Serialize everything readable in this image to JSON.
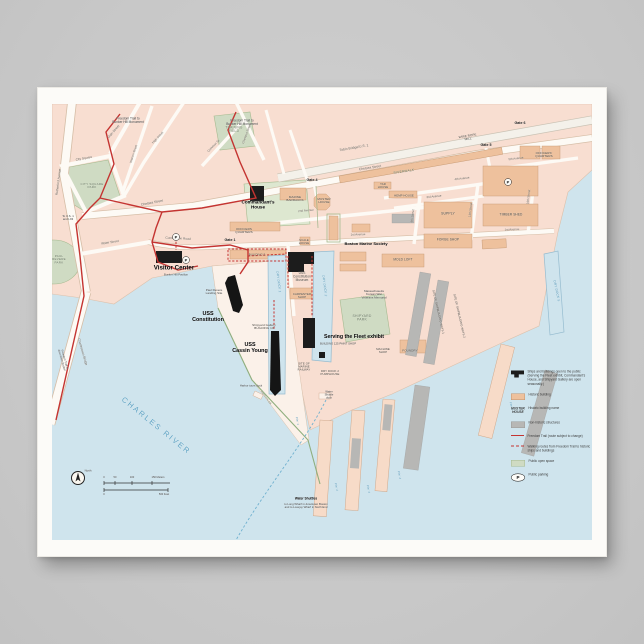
{
  "colors": {
    "page_background": "#c7c7c7",
    "poster_paper": "#fcfbf8",
    "water": "#cfe4ed",
    "land": "#f8ded1",
    "historic_building": "#eec19d",
    "nonhistoric_structure": "#b7b7b5",
    "open_space_green": "#cfdbc3",
    "freedom_trail_red": "#c43431",
    "open_public_black": "#1c1c1c",
    "water_label_blue": "#4e93b5",
    "river_label_blue": "#5aa0c2"
  },
  "map": {
    "labels": [
      {
        "t": "Freedom Trail to\nBunker Hill Monument",
        "x": 76,
        "y": 17,
        "f": 3.2,
        "c": "tiny"
      },
      {
        "t": "Freedom Trail to\nBunker Hill Monument",
        "x": 190,
        "y": 19,
        "f": 3.2,
        "c": "tiny"
      },
      {
        "t": "TRAINING\nFIELD",
        "x": 182,
        "y": 26,
        "f": 3.2,
        "c": "park"
      },
      {
        "t": "Gate 6",
        "x": 468,
        "y": 19,
        "f": 3.6,
        "c": "gate"
      },
      {
        "t": "Gate 5",
        "x": 434,
        "y": 41,
        "f": 3.6,
        "c": "gate"
      },
      {
        "t": "Gate 4",
        "x": 260,
        "y": 76,
        "f": 3.6,
        "c": "gate"
      },
      {
        "t": "Gate 1",
        "x": 178,
        "y": 136,
        "f": 3.6,
        "c": "gate"
      },
      {
        "t": "Tobin Bridge/U.S. 1",
        "x": 302,
        "y": 44,
        "f": 3.4,
        "c": "street",
        "r": -10
      },
      {
        "t": "Chelsea Street",
        "x": 100,
        "y": 99,
        "f": 3.4,
        "c": "street",
        "r": -11
      },
      {
        "t": "Chelsea Street",
        "x": 318,
        "y": 64,
        "f": 3.4,
        "c": "street",
        "r": -9
      },
      {
        "t": "RIVERWALK",
        "x": 352,
        "y": 68,
        "f": 3.2,
        "c": "park",
        "r": -9
      },
      {
        "t": "Main Street",
        "x": 62,
        "y": 28,
        "f": 3.2,
        "c": "street",
        "r": -49
      },
      {
        "t": "Warren Street",
        "x": 82,
        "y": 50,
        "f": 3,
        "c": "street",
        "r": -72
      },
      {
        "t": "High Street",
        "x": 106,
        "y": 34,
        "f": 3,
        "c": "street",
        "r": -47
      },
      {
        "t": "Common St.",
        "x": 162,
        "y": 42,
        "f": 3,
        "c": "street",
        "r": -46
      },
      {
        "t": "Chestnut Street",
        "x": 195,
        "y": 30,
        "f": 3,
        "c": "street",
        "r": -70
      },
      {
        "t": "City Square",
        "x": 32,
        "y": 55,
        "f": 3.2,
        "c": "street",
        "r": -10
      },
      {
        "t": "CITY SQUARE\nPARK",
        "x": 40,
        "y": 82,
        "f": 3,
        "c": "park"
      },
      {
        "t": "Rutherford Avenue",
        "x": 7,
        "y": 78,
        "f": 3.2,
        "c": "street",
        "r": -83
      },
      {
        "t": "To U.S. 1\nand I-93",
        "x": 16,
        "y": 114,
        "f": 2.8,
        "c": "tiny"
      },
      {
        "t": "Water Street",
        "x": 58,
        "y": 139,
        "f": 3.2,
        "c": "street",
        "r": -9
      },
      {
        "t": "Constitution Road",
        "x": 126,
        "y": 135,
        "f": 3.2,
        "c": "street",
        "r": 3
      },
      {
        "t": "PAUL\nREVERE\nPARK",
        "x": 7,
        "y": 156,
        "f": 3,
        "c": "park"
      },
      {
        "t": "Charlestown Bridge",
        "x": 30,
        "y": 248,
        "f": 3.2,
        "c": "street",
        "r": 74
      },
      {
        "t": "Freedom Trail to\ndowntown Boston",
        "x": 11,
        "y": 256,
        "f": 2.8,
        "c": "tiny",
        "r": 74
      },
      {
        "t": "Commandant's\nHouse",
        "x": 206,
        "y": 101,
        "f": 4.6,
        "c": "poi",
        "n": "commandants-house-label"
      },
      {
        "t": "MARINE\nBARRACKS",
        "x": 243,
        "y": 95,
        "f": 3,
        "c": "bldg"
      },
      {
        "t": "MUSTER\nHOUSE",
        "x": 272,
        "y": 97,
        "f": 3,
        "c": "bldg"
      },
      {
        "t": "2nd Avenue",
        "x": 254,
        "y": 107,
        "f": 3,
        "c": "street",
        "r": -5
      },
      {
        "t": "3rd Avenue",
        "x": 382,
        "y": 93,
        "f": 3,
        "c": "street",
        "r": -6
      },
      {
        "t": "4th Avenue",
        "x": 410,
        "y": 75,
        "f": 3,
        "c": "street",
        "r": -7
      },
      {
        "t": "5th Avenue",
        "x": 464,
        "y": 55,
        "f": 3,
        "c": "street",
        "r": -7
      },
      {
        "t": "9th Street",
        "x": 361,
        "y": 112,
        "f": 3,
        "c": "street",
        "r": -83
      },
      {
        "t": "13th Street",
        "x": 419,
        "y": 106,
        "f": 3,
        "c": "street",
        "r": -83
      },
      {
        "t": "16th Street",
        "x": 477,
        "y": 93,
        "f": 3,
        "c": "street",
        "r": -83
      },
      {
        "t": "OFFICERS'\nQUARTERS",
        "x": 492,
        "y": 51,
        "f": 3,
        "c": "bldg"
      },
      {
        "t": "WIRE ROPE\nMILL",
        "x": 416,
        "y": 34,
        "f": 3,
        "c": "bldg",
        "r": -9
      },
      {
        "t": "TAR\nHOUSE",
        "x": 331,
        "y": 82,
        "f": 2.8,
        "c": "bldg"
      },
      {
        "t": "HEMP HOUSE",
        "x": 352,
        "y": 92,
        "f": 2.8,
        "c": "bldg"
      },
      {
        "t": "SUPPLY",
        "x": 396,
        "y": 110,
        "f": 3.4,
        "c": "bldg"
      },
      {
        "t": "FORGE SHOP",
        "x": 396,
        "y": 136,
        "f": 3.2,
        "c": "bldg"
      },
      {
        "t": "TIMBER SHED",
        "x": 459,
        "y": 111,
        "f": 3.2,
        "c": "bldg"
      },
      {
        "t": "MOLD LOFT",
        "x": 351,
        "y": 156,
        "f": 3.2,
        "c": "bldg"
      },
      {
        "t": "OFFICERS\nQUARTERS",
        "x": 192,
        "y": 127,
        "f": 3,
        "c": "bldg"
      },
      {
        "t": "BUILDING 5",
        "x": 205,
        "y": 151,
        "f": 2.8,
        "c": "bldg"
      },
      {
        "t": "SCALE\nHOUSE",
        "x": 252,
        "y": 138,
        "f": 2.8,
        "c": "bldg"
      },
      {
        "t": "Boston Marine Society",
        "x": 314,
        "y": 140,
        "f": 4,
        "c": "poi",
        "n": "boston-marine-society-label"
      },
      {
        "t": "1st Avenue",
        "x": 306,
        "y": 131,
        "f": 3,
        "c": "street",
        "r": -2
      },
      {
        "t": "1st Avenue",
        "x": 460,
        "y": 126,
        "f": 3,
        "c": "street",
        "r": -3
      },
      {
        "t": "Visitor Center",
        "x": 122,
        "y": 164,
        "f": 6.2,
        "c": "poi",
        "n": "visitor-center-label"
      },
      {
        "t": "Bunker Hill Pavilion",
        "x": 124,
        "y": 171,
        "f": 2.8,
        "c": "tiny"
      },
      {
        "t": "USS\nConstitution\nMuseum",
        "x": 250,
        "y": 173,
        "f": 3.2,
        "c": "bldg"
      },
      {
        "t": "Paul Revere\nLanding Site",
        "x": 162,
        "y": 188,
        "f": 3,
        "c": "tiny"
      },
      {
        "t": "USS\nConstitution",
        "x": 156,
        "y": 213,
        "f": 5.4,
        "c": "poi",
        "n": "uss-constitution-label"
      },
      {
        "t": "DRY DOCK 1",
        "x": 226,
        "y": 178,
        "f": 3.2,
        "c": "water",
        "r": 83
      },
      {
        "t": "DRY DOCK 2",
        "x": 272,
        "y": 182,
        "f": 3.2,
        "c": "water",
        "r": 83
      },
      {
        "t": "CARPENTER\nSHOP",
        "x": 250,
        "y": 192,
        "f": 2.8,
        "c": "bldg"
      },
      {
        "t": "Shipyard Gallery\nBUILDING 10",
        "x": 212,
        "y": 223,
        "f": 3,
        "c": "bldg"
      },
      {
        "t": "USS\nCassin Young",
        "x": 198,
        "y": 244,
        "f": 5.4,
        "c": "poi",
        "n": "uss-cassin-young-label"
      },
      {
        "t": "Serving the Fleet exhibit",
        "x": 302,
        "y": 233,
        "f": 5.2,
        "c": "poi",
        "n": "serving-the-fleet-label"
      },
      {
        "t": "BUILDING 125 PAINT SHOP",
        "x": 286,
        "y": 240,
        "f": 2.8,
        "c": "tiny"
      },
      {
        "t": "Massachusetts\nKorean War\nVeterans Memorial",
        "x": 322,
        "y": 191,
        "f": 3,
        "c": "tiny"
      },
      {
        "t": "SHIPYARD\nPARK",
        "x": 310,
        "y": 214,
        "f": 3.4,
        "c": "park"
      },
      {
        "t": "MACHINE\nSHOP",
        "x": 331,
        "y": 247,
        "f": 2.8,
        "c": "bldg"
      },
      {
        "t": "FOUNDRY",
        "x": 358,
        "y": 247,
        "f": 3,
        "c": "bldg"
      },
      {
        "t": "SITE OF\nMARINE\nRAILWAY",
        "x": 252,
        "y": 263,
        "f": 2.8,
        "c": "bldg"
      },
      {
        "t": "DRY DOCK 2\nPUMPHOUSE",
        "x": 278,
        "y": 269,
        "f": 2.8,
        "c": "bldg"
      },
      {
        "t": "Water\nShuttle\ndock",
        "x": 277,
        "y": 291,
        "f": 2.8,
        "c": "tiny"
      },
      {
        "t": "Harbor tours dock",
        "x": 199,
        "y": 282,
        "f": 2.8,
        "c": "tiny"
      },
      {
        "t": "SITE OF SHIPBUILDING WAYS 1",
        "x": 386,
        "y": 208,
        "f": 2.8,
        "c": "bldg",
        "r": 77
      },
      {
        "t": "SITE OF SHIPBUILDING WAYS 2",
        "x": 407,
        "y": 212,
        "f": 2.8,
        "c": "bldg",
        "r": 77
      },
      {
        "t": "DRY DOCK 5",
        "x": 504,
        "y": 187,
        "f": 3.2,
        "c": "water",
        "r": 78
      },
      {
        "t": "Pier 1",
        "x": 245,
        "y": 317,
        "f": 2.8,
        "c": "water",
        "r": 80
      },
      {
        "t": "Pier 2",
        "x": 284,
        "y": 383,
        "f": 2.8,
        "c": "water",
        "r": 80
      },
      {
        "t": "Pier 3",
        "x": 316,
        "y": 385,
        "f": 2.8,
        "c": "water",
        "r": 80
      },
      {
        "t": "Pier 4",
        "x": 347,
        "y": 371,
        "f": 2.8,
        "c": "water",
        "r": 80
      },
      {
        "t": "Pier 6",
        "x": 459,
        "y": 302,
        "f": 2.8,
        "c": "water",
        "r": 76
      },
      {
        "t": "Harborwalk",
        "x": 214,
        "y": 294,
        "f": 2.8,
        "c": "park",
        "r": 54
      },
      {
        "t": "CHARLES RIVER",
        "x": 104,
        "y": 322,
        "f": 7.5,
        "c": "river",
        "r": 39,
        "n": "charles-river-label"
      },
      {
        "t": "North",
        "x": 36,
        "y": 367,
        "f": 2.8,
        "c": "tiny"
      },
      {
        "t": "0",
        "x": 52,
        "y": 374,
        "f": 2.6,
        "c": "tiny"
      },
      {
        "t": "50",
        "x": 63,
        "y": 374,
        "f": 2.6,
        "c": "tiny"
      },
      {
        "t": "100",
        "x": 80,
        "y": 374,
        "f": 2.6,
        "c": "tiny"
      },
      {
        "t": "150 Meters",
        "x": 106,
        "y": 374,
        "f": 2.6,
        "c": "tiny"
      },
      {
        "t": "0",
        "x": 52,
        "y": 391,
        "f": 2.6,
        "c": "tiny"
      },
      {
        "t": "500 Feet",
        "x": 112,
        "y": 391,
        "f": 2.6,
        "c": "tiny"
      },
      {
        "t": "Water Shuttles",
        "x": 254,
        "y": 395,
        "f": 3.2,
        "c": "poi",
        "n": "water-shuttles-label"
      },
      {
        "t": "to Long Wharf in downtown Boston\nand to Lovejoy Wharf in North End",
        "x": 254,
        "y": 402,
        "f": 2.8,
        "c": "tiny"
      },
      {
        "t": "P",
        "x": 124,
        "y": 133,
        "f": 4,
        "c": "pbadge",
        "n": "parking-icon"
      },
      {
        "t": "P",
        "x": 134,
        "y": 156,
        "f": 4,
        "c": "pbadge",
        "n": "parking-icon"
      },
      {
        "t": "P",
        "x": 456,
        "y": 78,
        "f": 4,
        "c": "pbadge",
        "n": "parking-icon"
      }
    ],
    "legend": {
      "parking_letter": "P",
      "items": [
        {
          "swatch": "black-building",
          "text": "Ships and buildings open to the public (Serving the Fleet exhibit, Commandant's House, and Shipyard Gallery are open seasonally.)"
        },
        {
          "swatch": "historic",
          "text": "Historic building"
        },
        {
          "swatch": "name",
          "swatch_text": "MUSTER\nHOUSE",
          "text": "Historic building name"
        },
        {
          "swatch": "nonhistoric",
          "text": "Non-historic structures"
        },
        {
          "swatch": "trail",
          "text": "Freedom Trail (route subject to change)"
        },
        {
          "swatch": "walking",
          "text": "Walking routes from Freedom Trail to historic ships and buildings"
        },
        {
          "swatch": "openspace",
          "text": "Public open space"
        },
        {
          "swatch": "parking",
          "text": "Public parking"
        }
      ]
    }
  }
}
